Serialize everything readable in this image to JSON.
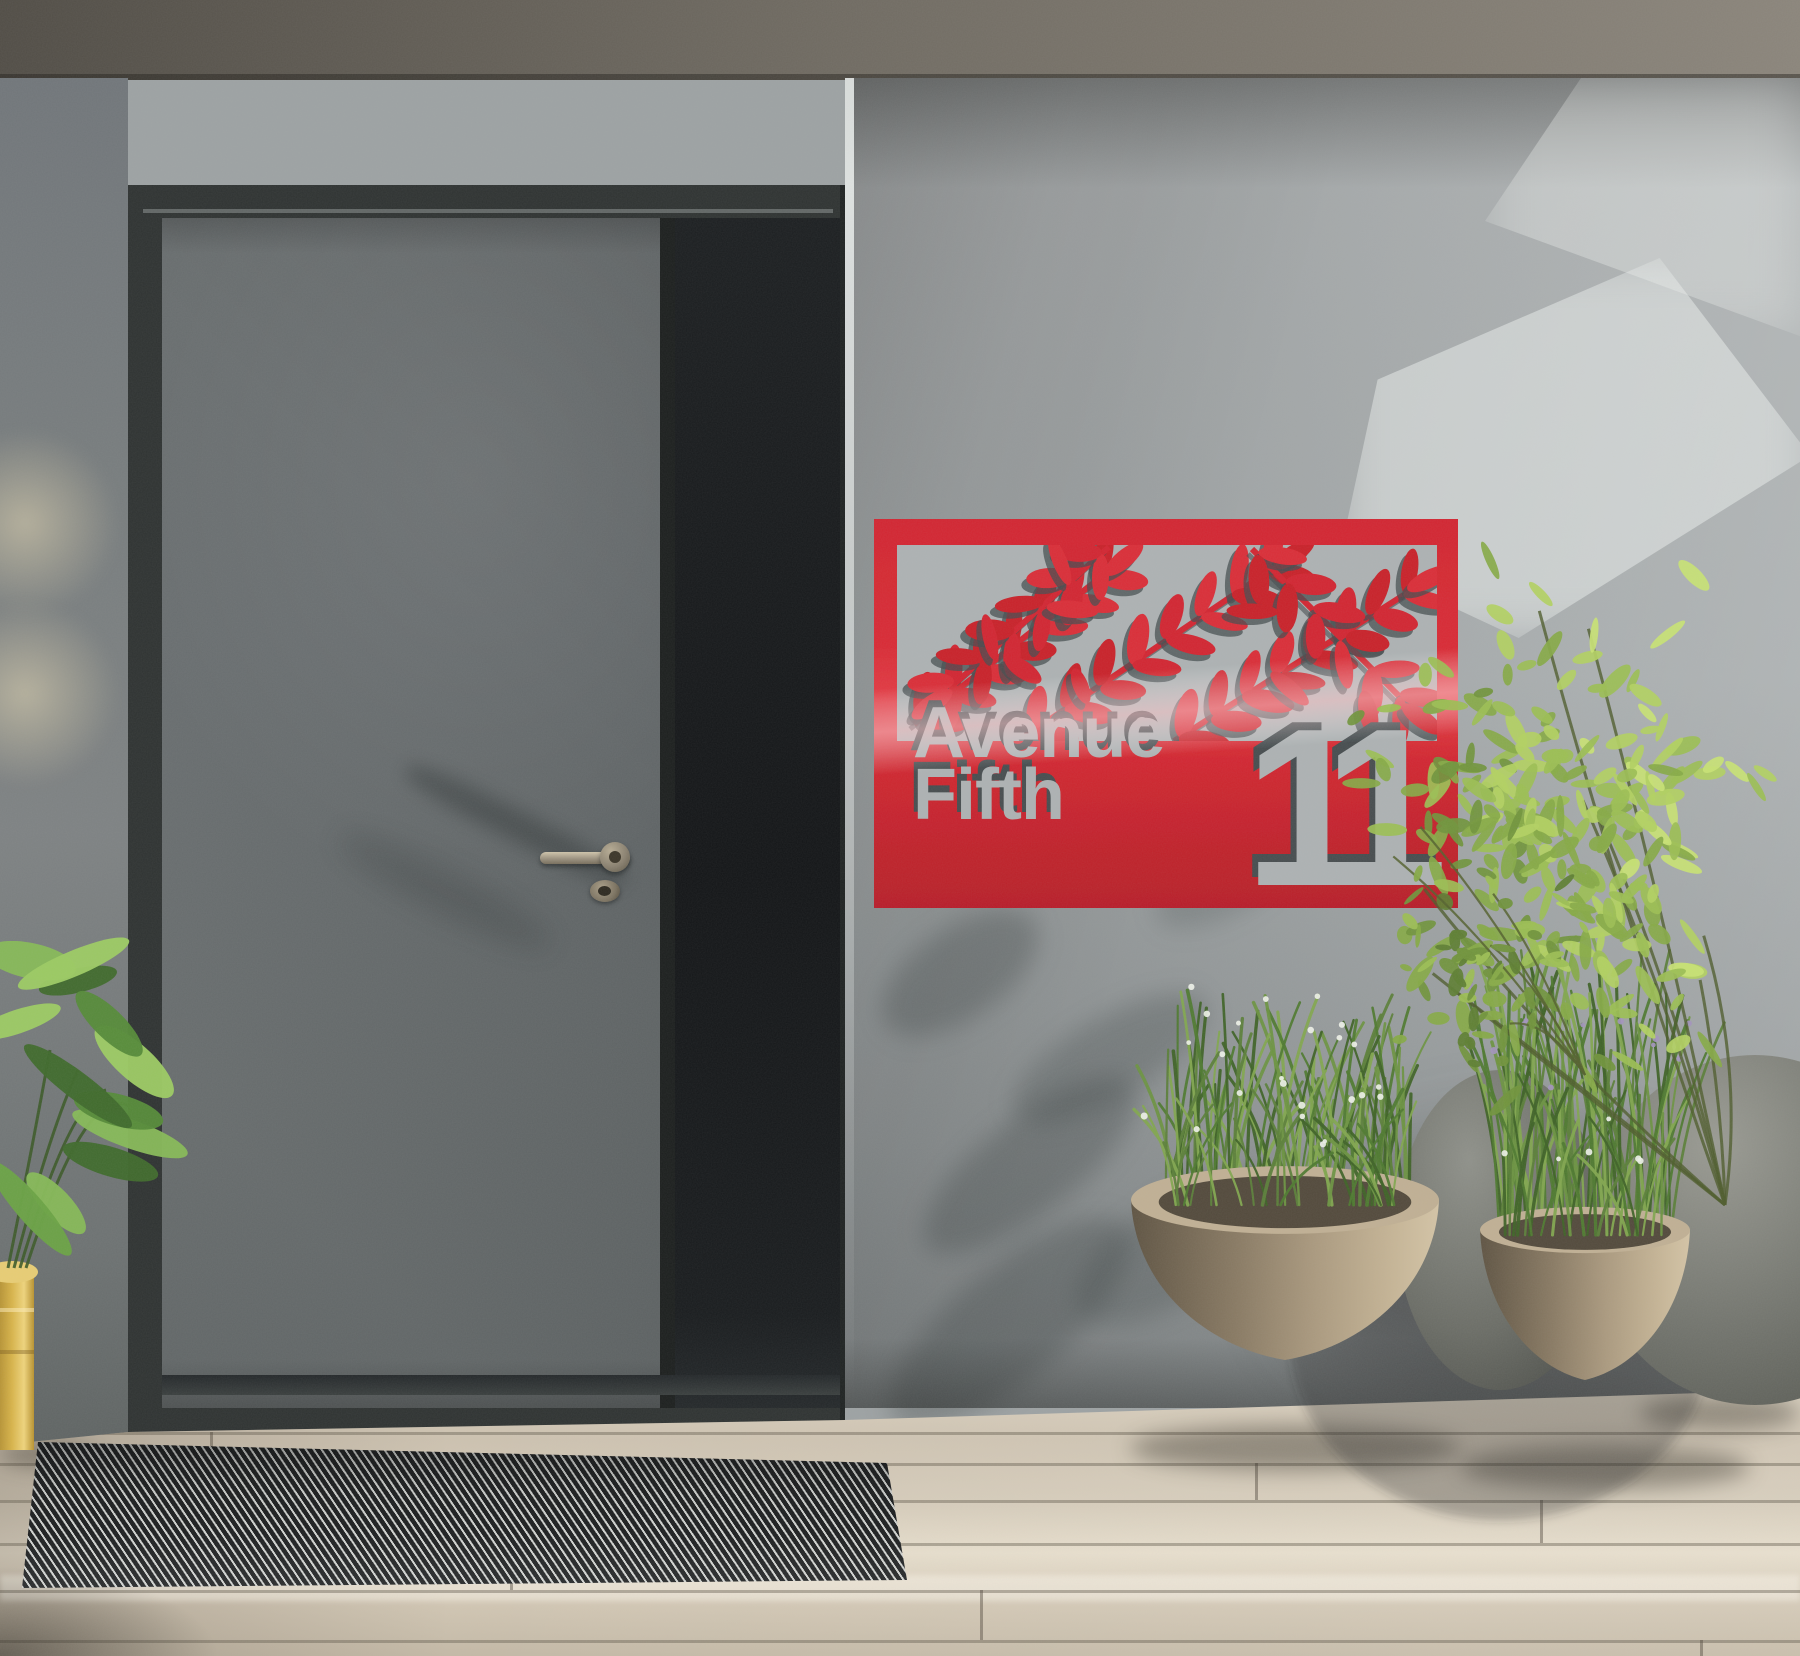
{
  "scene": {
    "description": "Modern house entrance: gray front door with dark sidelight, red laser-cut address plaque on a sunlit stucco wall, green shrub and potted plants on a wooden deck with a striped doormat",
    "sign": {
      "street_line1": "Avenue",
      "street_line2": "Fifth",
      "house_number": "11"
    },
    "colors": {
      "sign_red": "#d22730",
      "sign_red_deep": "#b81f29",
      "sign_red_highlight": "#f4606a",
      "sign_cut_silver": "#adb2b3",
      "sign_cut_shadow": "#474e50",
      "wall_gray": "#9da2a3",
      "wall_light": "#c0c4c4",
      "wall_shadow": "#6f7576",
      "beam_gray_dark": "#514d46",
      "beam_gray_light": "#8b857b",
      "door_gray": "#5e6364",
      "door_frame_dark": "#2c302f",
      "door_jamb_light": "#b0b5b4",
      "sidelight_black": "#17191b",
      "handle_metal": "#b1a78f",
      "deck_wood_light": "#e4dbc9",
      "deck_wood_mid": "#cbc0ae",
      "deck_wood_dark": "#a69c8c",
      "mat_dark": "#1d1f20",
      "mat_light": "#cfd1ce",
      "pot_tan": "#ab9a7f",
      "pot_tan_dark": "#6a5f4d",
      "stone_gray": "#73756e",
      "stone_gray_light": "#94958d",
      "planter_yellow": "#d8b44a",
      "foliage_dark": "#44602a",
      "foliage_mid": "#6d9139",
      "foliage_light": "#a9c95b",
      "foliage_sun": "#cfe47c",
      "grass_green": "#5c7f3a",
      "flower_white": "#eef1e8",
      "flower_purple": "#a394bd",
      "glow_warm": "#e6d9b4"
    }
  }
}
